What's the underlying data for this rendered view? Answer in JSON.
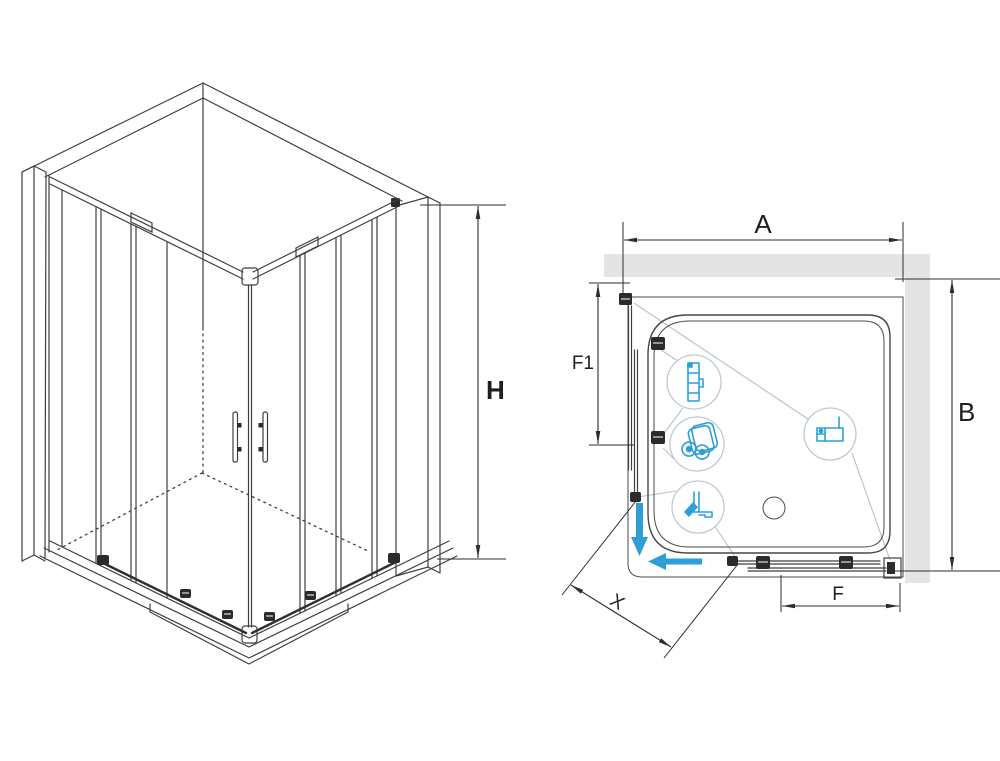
{
  "diagram": {
    "title": "shower-enclosure-technical-drawing",
    "views": [
      {
        "name": "isometric-view",
        "description": "3D corner shower enclosure with sliding doors"
      },
      {
        "name": "top-plan-view",
        "description": "plan view with walls, tray, doors and hardware callouts"
      }
    ],
    "dimensions": {
      "h": {
        "label": "H"
      },
      "a": {
        "label": "A"
      },
      "b": {
        "label": "B"
      },
      "f1": {
        "label": "F1"
      },
      "f": {
        "label": "F"
      },
      "x": {
        "label": "X"
      }
    },
    "details": [
      {
        "name": "wall-profile-detail",
        "icon": "wall-profile-icon"
      },
      {
        "name": "roller-detail",
        "icon": "double-roller-icon"
      },
      {
        "name": "corner-seal-detail",
        "icon": "corner-seal-icon"
      },
      {
        "name": "wall-bracket-detail",
        "icon": "wall-bracket-icon"
      }
    ],
    "icons": [
      "drain-icon",
      "slide-down-arrow-icon",
      "slide-left-arrow-icon",
      "door-handle-icon"
    ],
    "colors": {
      "accent_blue": "#2E9FD6",
      "wall_gray": "#E4E4E4",
      "line": "#3F3F3F",
      "callout_line": "#B0C4CF",
      "background": "#FFFFFF"
    }
  }
}
